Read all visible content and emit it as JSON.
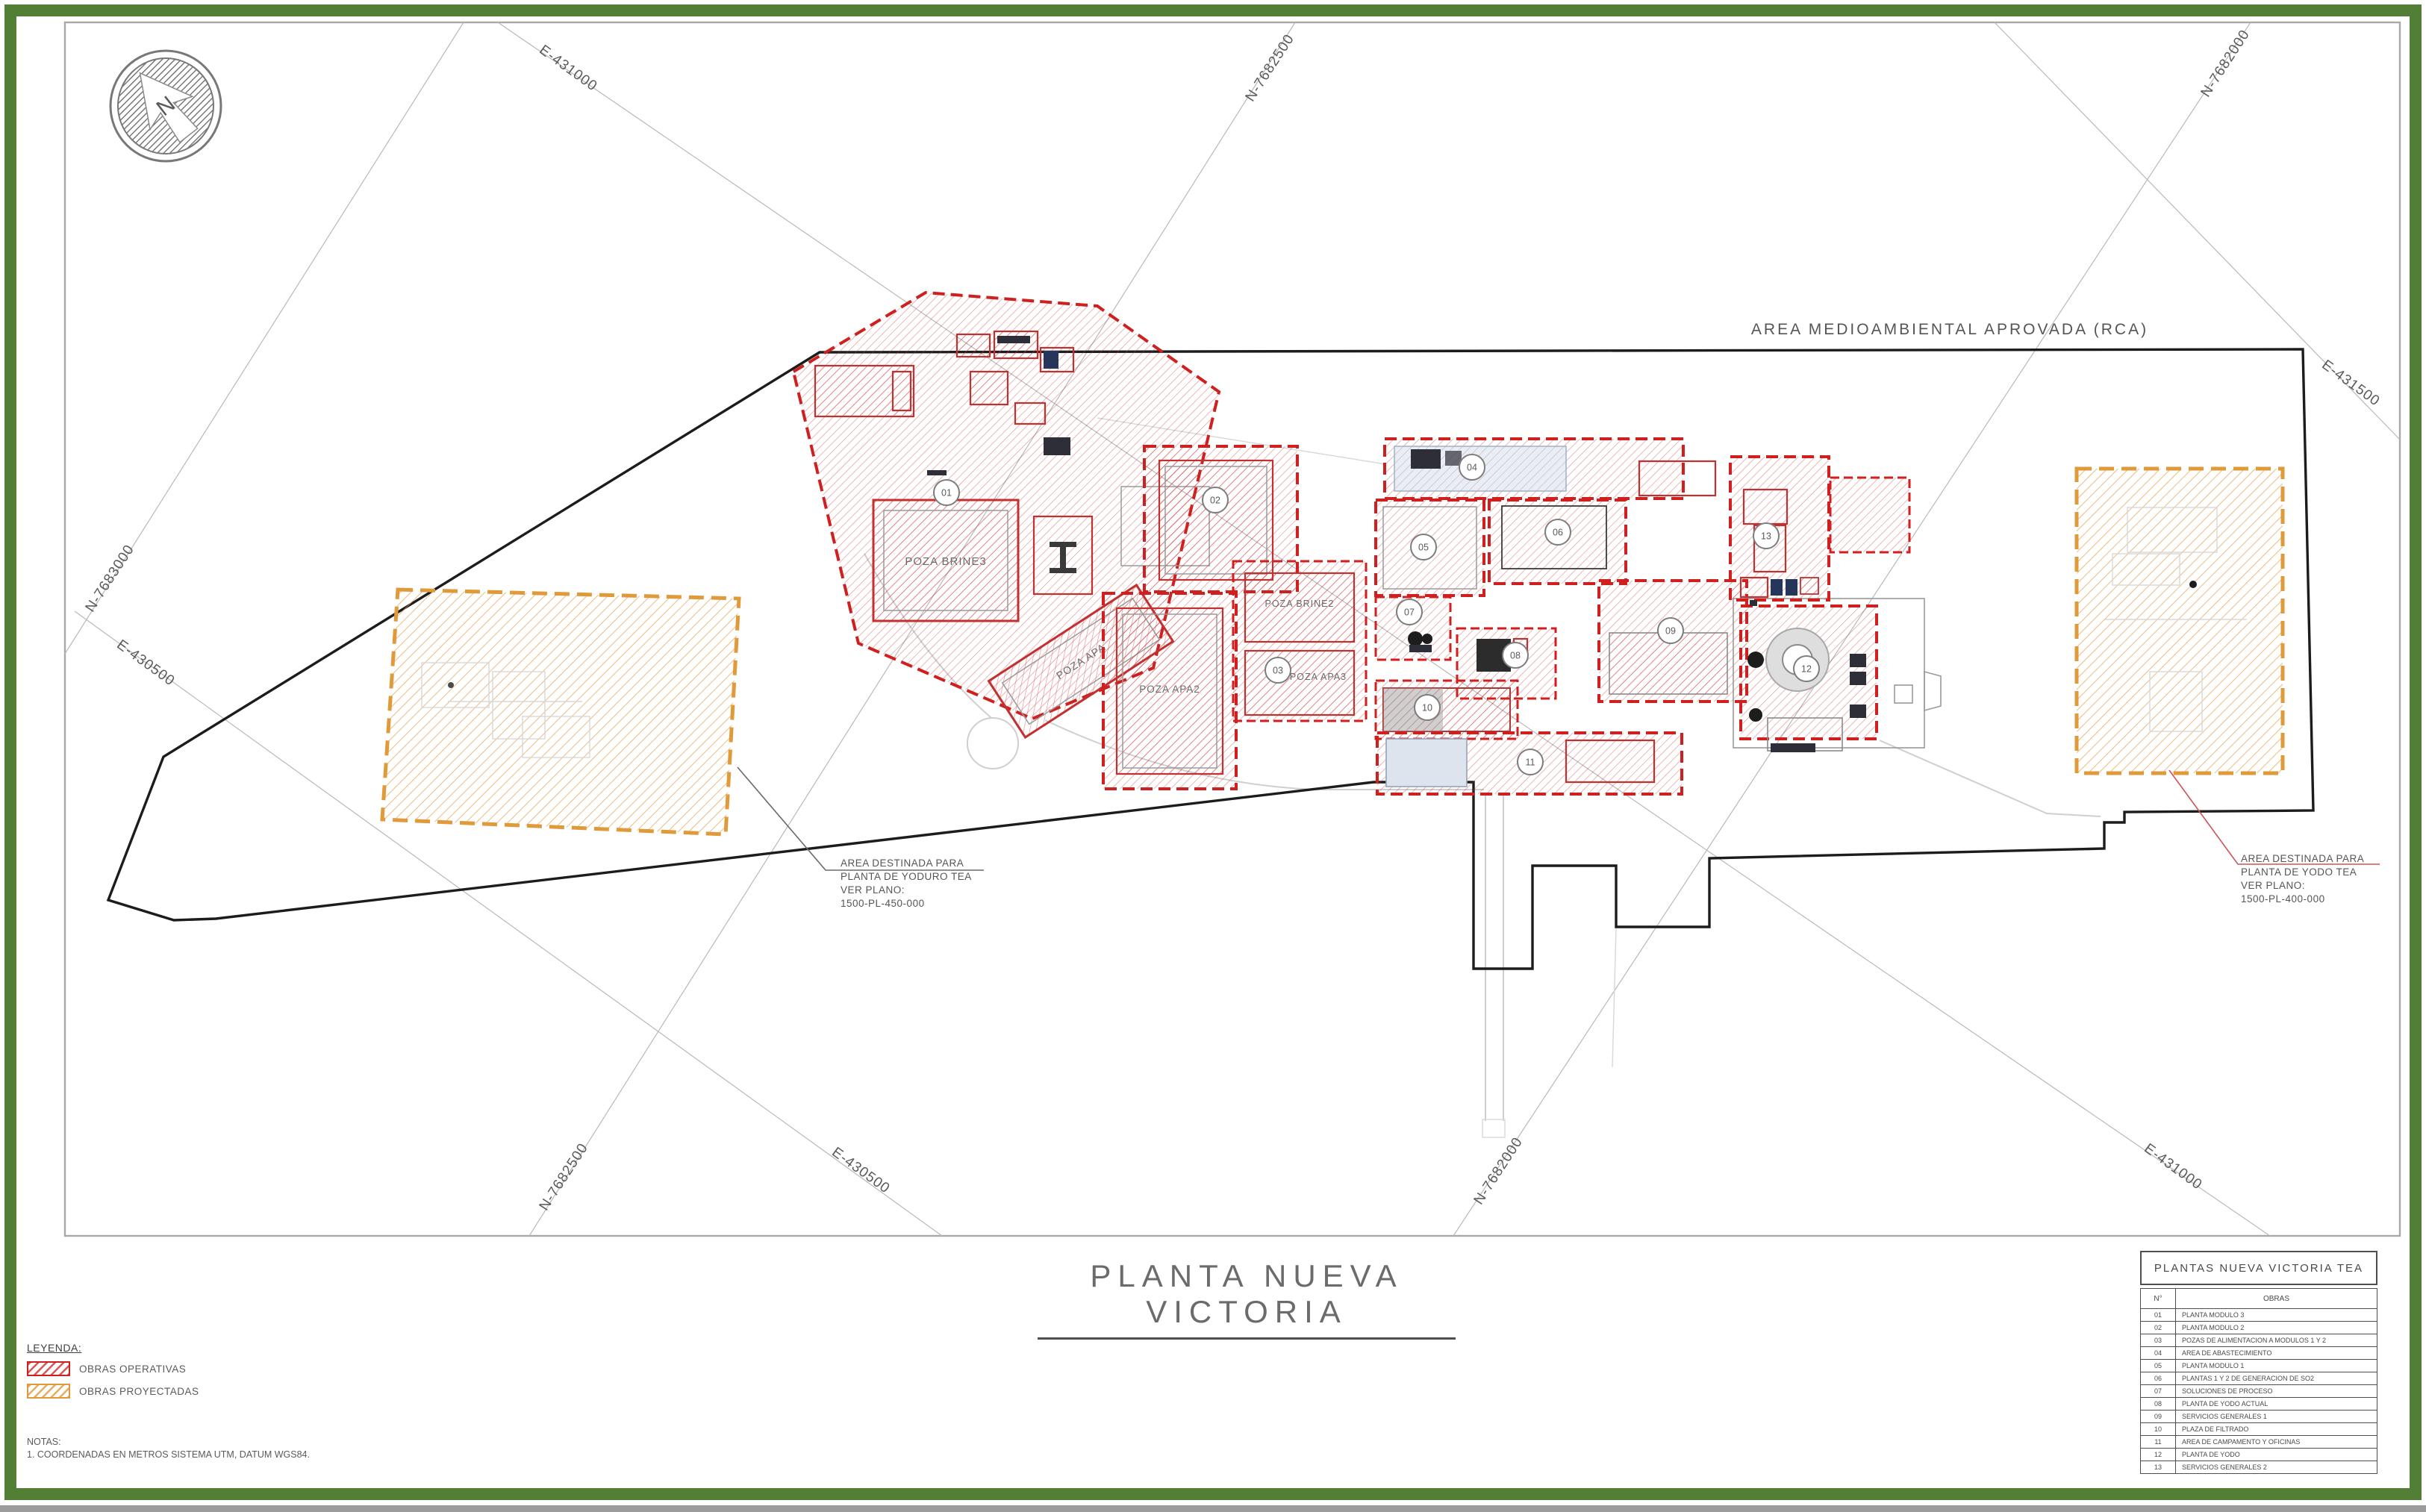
{
  "colors": {
    "frame_green": "#527e35",
    "obra_red": "#cf1f1f",
    "obra_orange": "#e09a3a"
  },
  "compass": {
    "label": "N"
  },
  "map": {
    "rca_label": "AREA MEDIOAMBIENTAL APROVADA (RCA)",
    "grid_labels": [
      {
        "text": "E-431000"
      },
      {
        "text": "N-7682500"
      },
      {
        "text": "N-7682000"
      },
      {
        "text": "E-431500"
      },
      {
        "text": "N-7683000"
      },
      {
        "text": "E-430500"
      },
      {
        "text": "N-7682500"
      },
      {
        "text": "E-430500"
      },
      {
        "text": "N-7682000"
      },
      {
        "text": "E-431000"
      }
    ],
    "pond_labels": {
      "brine3": "POZA BRINE3",
      "apa": "POZA APA",
      "brine2": "POZA BRINE2",
      "apa2": "POZA APA2",
      "apa3": "POZA APA3"
    },
    "badges": [
      "01",
      "02",
      "03",
      "04",
      "05",
      "06",
      "07",
      "08",
      "09",
      "10",
      "11",
      "12",
      "13"
    ]
  },
  "annotations": {
    "left": {
      "line1": "AREA DESTINADA PARA",
      "line2": "PLANTA DE YODURO TEA",
      "line3": "VER PLANO:",
      "line4": "1500-PL-450-000"
    },
    "right": {
      "line1": "AREA DESTINADA PARA",
      "line2": "PLANTA DE YODO TEA",
      "line3": "VER PLANO:",
      "line4": "1500-PL-400-000"
    }
  },
  "title": {
    "text": "PLANTA NUEVA VICTORIA"
  },
  "legend": {
    "heading": "LEYENDA:",
    "items": [
      {
        "label": "OBRAS OPERATIVAS",
        "color": "#cf1f1f"
      },
      {
        "label": "OBRAS PROYECTADAS",
        "color": "#e09a3a"
      }
    ]
  },
  "notes": {
    "heading": "NOTAS:",
    "line1": "1.   COORDENADAS EN METROS SISTEMA UTM, DATUM WGS84."
  },
  "table": {
    "title": "PLANTAS NUEVA VICTORIA TEA",
    "col_num": "N°",
    "col_obras": "OBRAS",
    "rows": [
      {
        "n": "01",
        "obra": "PLANTA MODULO 3"
      },
      {
        "n": "02",
        "obra": "PLANTA MODULO 2"
      },
      {
        "n": "03",
        "obra": "POZAS DE ALIMENTACION A MODULOS 1 Y 2"
      },
      {
        "n": "04",
        "obra": "AREA DE ABASTECIMIENTO"
      },
      {
        "n": "05",
        "obra": "PLANTA MODULO 1"
      },
      {
        "n": "06",
        "obra": "PLANTAS 1 Y 2 DE GENERACION DE SO2"
      },
      {
        "n": "07",
        "obra": "SOLUCIONES DE PROCESO"
      },
      {
        "n": "08",
        "obra": "PLANTA DE YODO ACTUAL"
      },
      {
        "n": "09",
        "obra": "SERVICIOS GENERALES 1"
      },
      {
        "n": "10",
        "obra": "PLAZA DE FILTRADO"
      },
      {
        "n": "11",
        "obra": "AREA DE CAMPAMENTO Y OFICINAS"
      },
      {
        "n": "12",
        "obra": "PLANTA DE YODO"
      },
      {
        "n": "13",
        "obra": "SERVICIOS GENERALES 2"
      }
    ]
  }
}
